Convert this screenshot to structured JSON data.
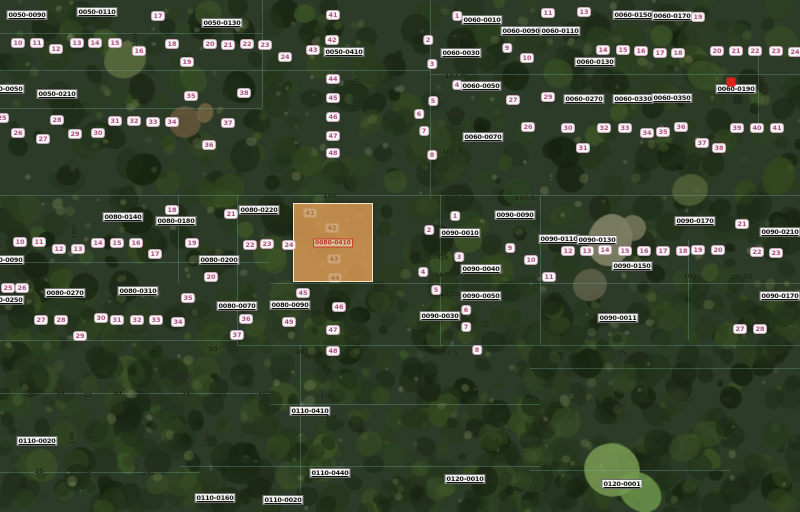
{
  "map": {
    "colors": {
      "selected_parcel_fill": "#df9e55",
      "selected_parcel_border": "#faecd0",
      "marker_red": "#e2211a",
      "lot_number_text": "#b04f7f",
      "parcel_label_text": "#101010",
      "boundary_line": "#7dc3be",
      "dimension_text": "#161c0c"
    },
    "selected_parcel": {
      "label": "0080-0410",
      "x": 293,
      "y": 203,
      "width": 80,
      "height": 79,
      "interior_lots": [
        {
          "text": "41",
          "x": 310,
          "y": 213
        },
        {
          "text": "42",
          "x": 332,
          "y": 228
        },
        {
          "text": "43",
          "x": 334,
          "y": 259
        },
        {
          "text": "44",
          "x": 335,
          "y": 278
        }
      ]
    },
    "marker": {
      "x": 731,
      "y": 82
    },
    "parcel_labels": [
      {
        "text": "0050-0090",
        "x": 27,
        "y": 15
      },
      {
        "text": "0050-0110",
        "x": 97,
        "y": 12
      },
      {
        "text": "0050-0130",
        "x": 222,
        "y": 23
      },
      {
        "text": "0040-0050",
        "x": 4,
        "y": 89
      },
      {
        "text": "0050-0210",
        "x": 57,
        "y": 94
      },
      {
        "text": "0050-0410",
        "x": 344,
        "y": 52
      },
      {
        "text": "0060-0010",
        "x": 482,
        "y": 20
      },
      {
        "text": "0060-0090",
        "x": 521,
        "y": 31
      },
      {
        "text": "0060-0030",
        "x": 461,
        "y": 53
      },
      {
        "text": "0060-0050",
        "x": 481,
        "y": 86
      },
      {
        "text": "0060-0070",
        "x": 483,
        "y": 137
      },
      {
        "text": "0060-0110",
        "x": 560,
        "y": 31
      },
      {
        "text": "0060-0150",
        "x": 633,
        "y": 15
      },
      {
        "text": "0060-0170",
        "x": 672,
        "y": 16
      },
      {
        "text": "0060-0130",
        "x": 595,
        "y": 62
      },
      {
        "text": "0060-0270",
        "x": 584,
        "y": 99
      },
      {
        "text": "0060-0330",
        "x": 633,
        "y": 99
      },
      {
        "text": "0060-0350",
        "x": 672,
        "y": 98
      },
      {
        "text": "0060-0190",
        "x": 736,
        "y": 89
      },
      {
        "text": "0080-0140",
        "x": 123,
        "y": 217
      },
      {
        "text": "0080-0180",
        "x": 176,
        "y": 221
      },
      {
        "text": "0080-0220",
        "x": 259,
        "y": 210
      },
      {
        "text": "0080-0200",
        "x": 219,
        "y": 260
      },
      {
        "text": "0080-0090",
        "x": 4,
        "y": 260
      },
      {
        "text": "0080-0250",
        "x": 4,
        "y": 300
      },
      {
        "text": "0080-0270",
        "x": 65,
        "y": 293
      },
      {
        "text": "0080-0310",
        "x": 138,
        "y": 291
      },
      {
        "text": "0080-0070",
        "x": 237,
        "y": 306
      },
      {
        "text": "0080-0090",
        "x": 290,
        "y": 305
      },
      {
        "text": "0090-0090",
        "x": 515,
        "y": 215
      },
      {
        "text": "0090-0010",
        "x": 460,
        "y": 233
      },
      {
        "text": "0090-0040",
        "x": 481,
        "y": 269
      },
      {
        "text": "0090-0050",
        "x": 481,
        "y": 296
      },
      {
        "text": "0090-0030",
        "x": 440,
        "y": 316
      },
      {
        "text": "0090-0110",
        "x": 559,
        "y": 239
      },
      {
        "text": "0090-0130",
        "x": 597,
        "y": 240
      },
      {
        "text": "0090-0150",
        "x": 632,
        "y": 266
      },
      {
        "text": "0090-0011",
        "x": 618,
        "y": 318
      },
      {
        "text": "0090-0170",
        "x": 695,
        "y": 221
      },
      {
        "text": "0090-0210",
        "x": 780,
        "y": 232
      },
      {
        "text": "0090-0170",
        "x": 780,
        "y": 296
      },
      {
        "text": "0110-0020",
        "x": 37,
        "y": 441
      },
      {
        "text": "0110-0160",
        "x": 215,
        "y": 498
      },
      {
        "text": "0110-0410",
        "x": 310,
        "y": 411
      },
      {
        "text": "0110-0440",
        "x": 330,
        "y": 473
      },
      {
        "text": "0110-0020",
        "x": 283,
        "y": 500
      },
      {
        "text": "0120-0010",
        "x": 465,
        "y": 479
      },
      {
        "text": "0120-0001",
        "x": 622,
        "y": 484
      }
    ],
    "lot_labels": [
      {
        "text": "10",
        "x": 18,
        "y": 43
      },
      {
        "text": "11",
        "x": 37,
        "y": 43
      },
      {
        "text": "12",
        "x": 56,
        "y": 49
      },
      {
        "text": "13",
        "x": 77,
        "y": 43
      },
      {
        "text": "14",
        "x": 95,
        "y": 43
      },
      {
        "text": "15",
        "x": 115,
        "y": 43
      },
      {
        "text": "16",
        "x": 139,
        "y": 51
      },
      {
        "text": "17",
        "x": 158,
        "y": 16
      },
      {
        "text": "18",
        "x": 172,
        "y": 44
      },
      {
        "text": "19",
        "x": 187,
        "y": 62
      },
      {
        "text": "20",
        "x": 210,
        "y": 44
      },
      {
        "text": "21",
        "x": 228,
        "y": 45
      },
      {
        "text": "22",
        "x": 247,
        "y": 44
      },
      {
        "text": "23",
        "x": 265,
        "y": 45
      },
      {
        "text": "24",
        "x": 285,
        "y": 57
      },
      {
        "text": "25",
        "x": 2,
        "y": 118
      },
      {
        "text": "26",
        "x": 18,
        "y": 133
      },
      {
        "text": "27",
        "x": 43,
        "y": 139
      },
      {
        "text": "28",
        "x": 57,
        "y": 120
      },
      {
        "text": "29",
        "x": 75,
        "y": 134
      },
      {
        "text": "30",
        "x": 98,
        "y": 133
      },
      {
        "text": "31",
        "x": 115,
        "y": 121
      },
      {
        "text": "32",
        "x": 134,
        "y": 121
      },
      {
        "text": "33",
        "x": 153,
        "y": 122
      },
      {
        "text": "34",
        "x": 172,
        "y": 122
      },
      {
        "text": "35",
        "x": 191,
        "y": 96
      },
      {
        "text": "36",
        "x": 209,
        "y": 145
      },
      {
        "text": "37",
        "x": 228,
        "y": 123
      },
      {
        "text": "38",
        "x": 244,
        "y": 93
      },
      {
        "text": "41",
        "x": 333,
        "y": 15
      },
      {
        "text": "42",
        "x": 332,
        "y": 40
      },
      {
        "text": "43",
        "x": 313,
        "y": 50
      },
      {
        "text": "44",
        "x": 333,
        "y": 79
      },
      {
        "text": "45",
        "x": 333,
        "y": 98
      },
      {
        "text": "46",
        "x": 333,
        "y": 117
      },
      {
        "text": "47",
        "x": 333,
        "y": 136
      },
      {
        "text": "48",
        "x": 333,
        "y": 153
      },
      {
        "text": "1",
        "x": 457,
        "y": 16
      },
      {
        "text": "2",
        "x": 428,
        "y": 40
      },
      {
        "text": "3",
        "x": 432,
        "y": 64
      },
      {
        "text": "4",
        "x": 457,
        "y": 85
      },
      {
        "text": "5",
        "x": 433,
        "y": 101
      },
      {
        "text": "6",
        "x": 419,
        "y": 114
      },
      {
        "text": "7",
        "x": 424,
        "y": 131
      },
      {
        "text": "8",
        "x": 432,
        "y": 155
      },
      {
        "text": "9",
        "x": 507,
        "y": 48
      },
      {
        "text": "10",
        "x": 527,
        "y": 58
      },
      {
        "text": "27",
        "x": 513,
        "y": 100
      },
      {
        "text": "26",
        "x": 528,
        "y": 127
      },
      {
        "text": "11",
        "x": 548,
        "y": 13
      },
      {
        "text": "13",
        "x": 584,
        "y": 12
      },
      {
        "text": "14",
        "x": 603,
        "y": 50
      },
      {
        "text": "15",
        "x": 623,
        "y": 50
      },
      {
        "text": "16",
        "x": 641,
        "y": 51
      },
      {
        "text": "17",
        "x": 660,
        "y": 53
      },
      {
        "text": "18",
        "x": 678,
        "y": 53
      },
      {
        "text": "19",
        "x": 698,
        "y": 17
      },
      {
        "text": "20",
        "x": 717,
        "y": 51
      },
      {
        "text": "21",
        "x": 736,
        "y": 51
      },
      {
        "text": "22",
        "x": 755,
        "y": 51
      },
      {
        "text": "23",
        "x": 776,
        "y": 51
      },
      {
        "text": "24",
        "x": 795,
        "y": 52
      },
      {
        "text": "29",
        "x": 548,
        "y": 97
      },
      {
        "text": "30",
        "x": 568,
        "y": 128
      },
      {
        "text": "31",
        "x": 583,
        "y": 148
      },
      {
        "text": "32",
        "x": 604,
        "y": 128
      },
      {
        "text": "33",
        "x": 625,
        "y": 128
      },
      {
        "text": "34",
        "x": 647,
        "y": 133
      },
      {
        "text": "35",
        "x": 663,
        "y": 132
      },
      {
        "text": "36",
        "x": 681,
        "y": 127
      },
      {
        "text": "37",
        "x": 702,
        "y": 143
      },
      {
        "text": "38",
        "x": 719,
        "y": 148
      },
      {
        "text": "39",
        "x": 737,
        "y": 128
      },
      {
        "text": "40",
        "x": 757,
        "y": 128
      },
      {
        "text": "41",
        "x": 777,
        "y": 128
      },
      {
        "text": "10",
        "x": 20,
        "y": 242
      },
      {
        "text": "11",
        "x": 39,
        "y": 242
      },
      {
        "text": "12",
        "x": 59,
        "y": 249
      },
      {
        "text": "13",
        "x": 78,
        "y": 249
      },
      {
        "text": "14",
        "x": 98,
        "y": 243
      },
      {
        "text": "15",
        "x": 117,
        "y": 243
      },
      {
        "text": "16",
        "x": 136,
        "y": 243
      },
      {
        "text": "17",
        "x": 155,
        "y": 254
      },
      {
        "text": "18",
        "x": 172,
        "y": 210
      },
      {
        "text": "19",
        "x": 192,
        "y": 243
      },
      {
        "text": "20",
        "x": 211,
        "y": 277
      },
      {
        "text": "21",
        "x": 231,
        "y": 214
      },
      {
        "text": "22",
        "x": 250,
        "y": 245
      },
      {
        "text": "23",
        "x": 267,
        "y": 244
      },
      {
        "text": "24",
        "x": 289,
        "y": 245
      },
      {
        "text": "25",
        "x": 8,
        "y": 288
      },
      {
        "text": "26",
        "x": 22,
        "y": 288
      },
      {
        "text": "27",
        "x": 41,
        "y": 320
      },
      {
        "text": "28",
        "x": 61,
        "y": 320
      },
      {
        "text": "29",
        "x": 80,
        "y": 336
      },
      {
        "text": "30",
        "x": 101,
        "y": 318
      },
      {
        "text": "31",
        "x": 117,
        "y": 320
      },
      {
        "text": "32",
        "x": 137,
        "y": 320
      },
      {
        "text": "33",
        "x": 156,
        "y": 320
      },
      {
        "text": "34",
        "x": 178,
        "y": 322
      },
      {
        "text": "35",
        "x": 188,
        "y": 298
      },
      {
        "text": "36",
        "x": 246,
        "y": 319
      },
      {
        "text": "37",
        "x": 237,
        "y": 335
      },
      {
        "text": "45",
        "x": 303,
        "y": 293
      },
      {
        "text": "46",
        "x": 339,
        "y": 307
      },
      {
        "text": "47",
        "x": 333,
        "y": 330
      },
      {
        "text": "48",
        "x": 333,
        "y": 351
      },
      {
        "text": "49",
        "x": 289,
        "y": 322
      },
      {
        "text": "1",
        "x": 455,
        "y": 216
      },
      {
        "text": "2",
        "x": 429,
        "y": 230
      },
      {
        "text": "3",
        "x": 459,
        "y": 257
      },
      {
        "text": "4",
        "x": 423,
        "y": 272
      },
      {
        "text": "5",
        "x": 436,
        "y": 290
      },
      {
        "text": "6",
        "x": 466,
        "y": 310
      },
      {
        "text": "7",
        "x": 466,
        "y": 327
      },
      {
        "text": "8",
        "x": 477,
        "y": 350
      },
      {
        "text": "9",
        "x": 510,
        "y": 248
      },
      {
        "text": "10",
        "x": 531,
        "y": 260
      },
      {
        "text": "11",
        "x": 549,
        "y": 277
      },
      {
        "text": "12",
        "x": 568,
        "y": 251
      },
      {
        "text": "13",
        "x": 587,
        "y": 251
      },
      {
        "text": "14",
        "x": 605,
        "y": 250
      },
      {
        "text": "15",
        "x": 625,
        "y": 251
      },
      {
        "text": "16",
        "x": 644,
        "y": 251
      },
      {
        "text": "17",
        "x": 663,
        "y": 251
      },
      {
        "text": "18",
        "x": 683,
        "y": 251
      },
      {
        "text": "19",
        "x": 698,
        "y": 250
      },
      {
        "text": "20",
        "x": 718,
        "y": 250
      },
      {
        "text": "21",
        "x": 742,
        "y": 224
      },
      {
        "text": "22",
        "x": 757,
        "y": 252
      },
      {
        "text": "23",
        "x": 776,
        "y": 253
      },
      {
        "text": "27",
        "x": 740,
        "y": 329
      },
      {
        "text": "28",
        "x": 760,
        "y": 329
      }
    ],
    "dim_labels": [
      {
        "text": "100",
        "x": 330,
        "y": 196,
        "rot": 0
      },
      {
        "text": "110",
        "x": 361,
        "y": 255,
        "rot": 1
      },
      {
        "text": "110",
        "x": 357,
        "y": 85,
        "rot": 1
      },
      {
        "text": "100",
        "x": 135,
        "y": 40,
        "rot": 1
      },
      {
        "text": "107.5",
        "x": 458,
        "y": 37,
        "rot": 0
      },
      {
        "text": "107.0",
        "x": 455,
        "y": 76,
        "rot": 0
      },
      {
        "text": "107.5",
        "x": 455,
        "y": 113,
        "rot": 0
      },
      {
        "text": "107.5",
        "x": 452,
        "y": 152,
        "rot": 0
      },
      {
        "text": "107.5",
        "x": 455,
        "y": 198,
        "rot": 0
      },
      {
        "text": "107.5",
        "x": 438,
        "y": 257,
        "rot": 0
      },
      {
        "text": "107.5",
        "x": 445,
        "y": 275,
        "rot": 0
      },
      {
        "text": "107.5",
        "x": 450,
        "y": 294,
        "rot": 0
      },
      {
        "text": "107",
        "x": 302,
        "y": 352,
        "rot": 0
      },
      {
        "text": "107.5",
        "x": 448,
        "y": 353,
        "rot": 0
      },
      {
        "text": "100",
        "x": 327,
        "y": 396,
        "rot": 0
      },
      {
        "text": "100",
        "x": 332,
        "y": 417,
        "rot": 0
      },
      {
        "text": "150",
        "x": 207,
        "y": 440,
        "rot": 1
      },
      {
        "text": "110",
        "x": 224,
        "y": 480,
        "rot": 1
      },
      {
        "text": "100",
        "x": 72,
        "y": 438,
        "rot": 1
      },
      {
        "text": "107",
        "x": 93,
        "y": 437,
        "rot": 1
      },
      {
        "text": "100",
        "x": 74,
        "y": 232,
        "rot": 1
      },
      {
        "text": "200",
        "x": 762,
        "y": 83,
        "rot": 1
      },
      {
        "text": "25",
        "x": 157,
        "y": 350,
        "rot": 0
      },
      {
        "text": "50",
        "x": 213,
        "y": 349,
        "rot": 0
      },
      {
        "text": "25",
        "x": 32,
        "y": 395,
        "rot": 0
      },
      {
        "text": "50",
        "x": 60,
        "y": 393,
        "rot": 0
      },
      {
        "text": "25",
        "x": 88,
        "y": 395,
        "rot": 0
      },
      {
        "text": "50",
        "x": 117,
        "y": 393,
        "rot": 0
      },
      {
        "text": "25",
        "x": 145,
        "y": 396,
        "rot": 0
      },
      {
        "text": "75",
        "x": 186,
        "y": 394,
        "rot": 0
      },
      {
        "text": "25",
        "x": 222,
        "y": 396,
        "rot": 0
      },
      {
        "text": "75",
        "x": 262,
        "y": 395,
        "rot": 0
      },
      {
        "text": "25",
        "x": 39,
        "y": 471,
        "rot": 0
      },
      {
        "text": "25",
        "x": 87,
        "y": 473,
        "rot": 0
      },
      {
        "text": "25",
        "x": 146,
        "y": 473,
        "rot": 0
      },
      {
        "text": "25",
        "x": 622,
        "y": 353,
        "rot": 0
      },
      {
        "text": "75",
        "x": 777,
        "y": 353,
        "rot": 0
      },
      {
        "text": "50",
        "x": 533,
        "y": 399,
        "rot": 0
      },
      {
        "text": "25",
        "x": 582,
        "y": 397,
        "rot": 0
      },
      {
        "text": "75",
        "x": 640,
        "y": 399,
        "rot": 0
      },
      {
        "text": "25",
        "x": 688,
        "y": 399,
        "rot": 0
      },
      {
        "text": "25",
        "x": 727,
        "y": 400,
        "rot": 0
      },
      {
        "text": "100",
        "x": 690,
        "y": 276,
        "rot": 0
      },
      {
        "text": "25",
        "x": 735,
        "y": 277,
        "rot": 0
      },
      {
        "text": "75",
        "x": 748,
        "y": 277,
        "rot": 0
      },
      {
        "text": "107.5",
        "x": 525,
        "y": 198,
        "rot": 0
      }
    ]
  }
}
